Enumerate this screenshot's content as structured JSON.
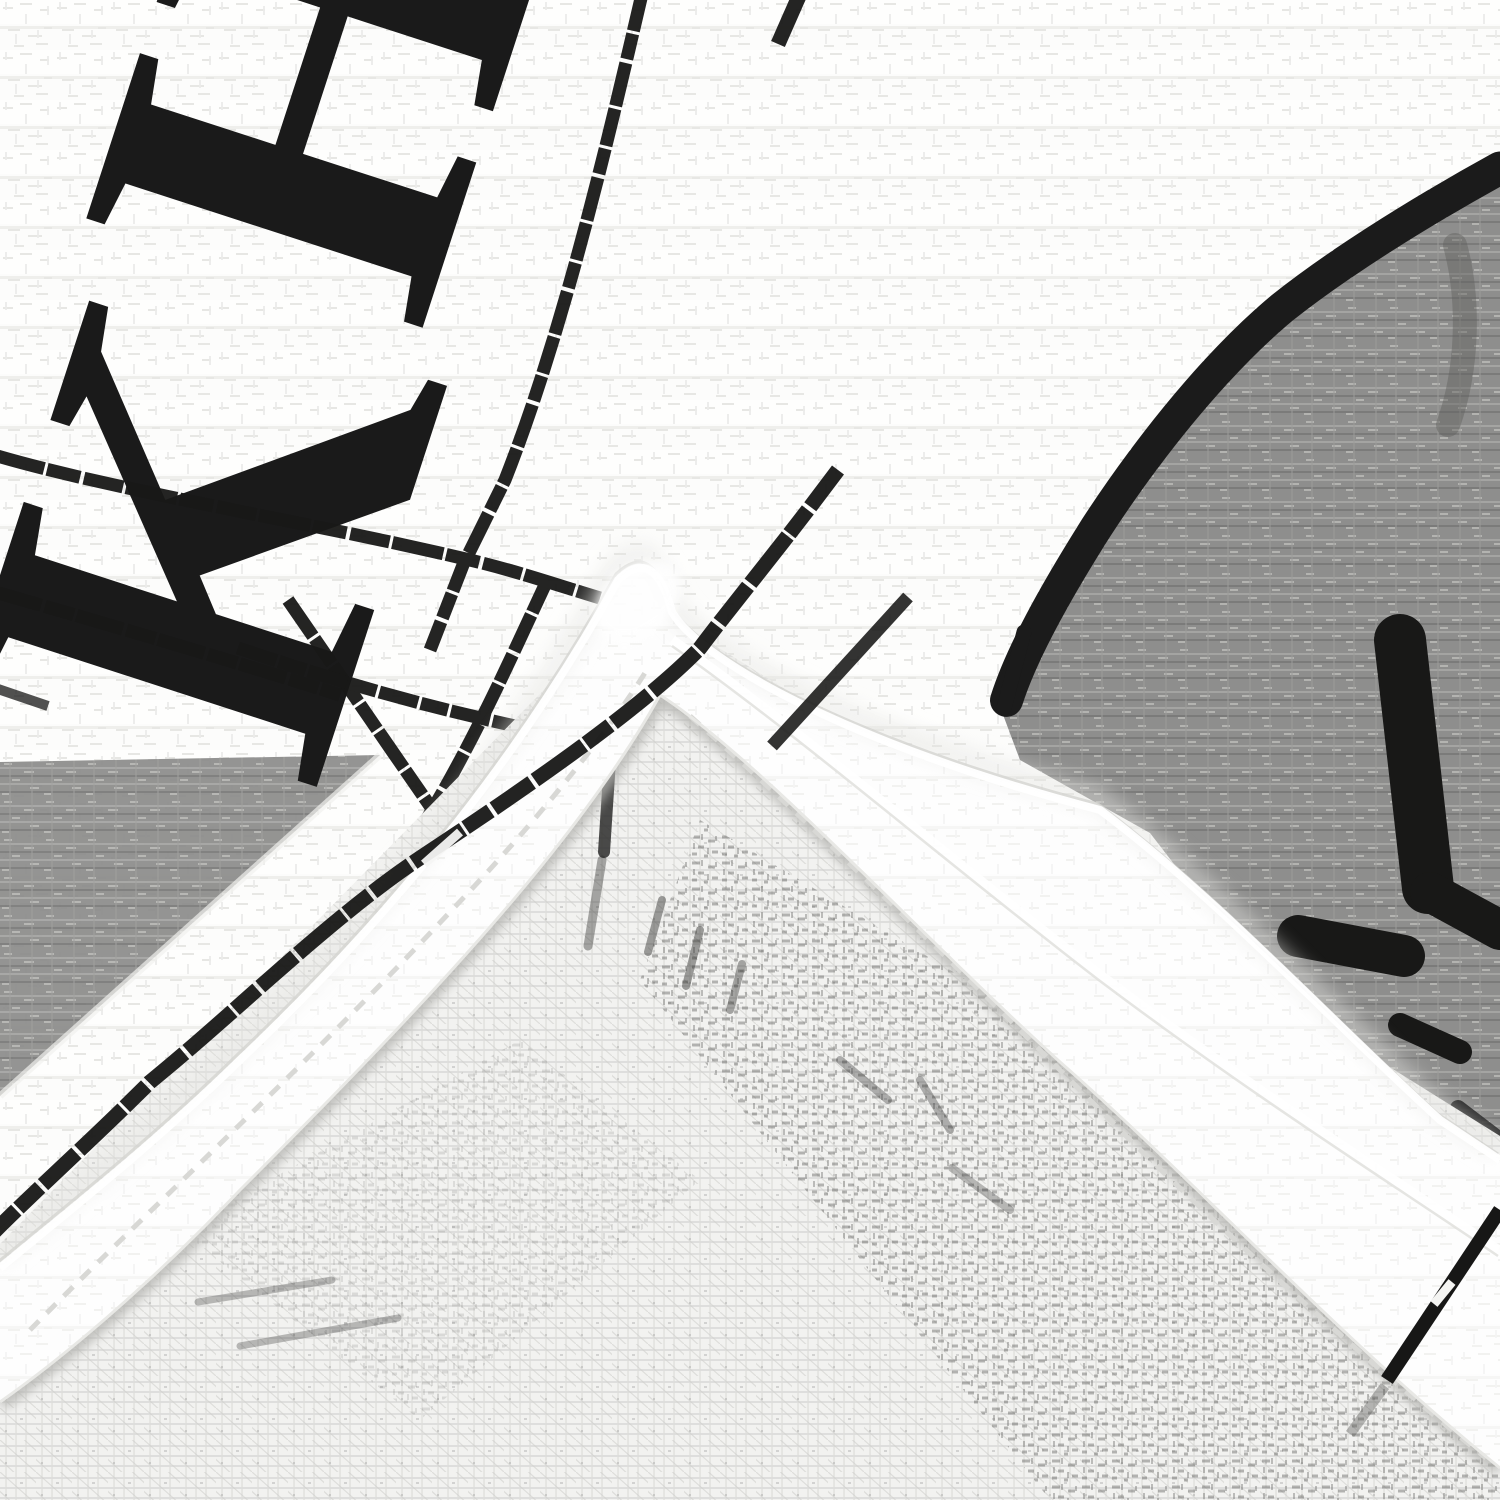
{
  "image": {
    "kind": "photograph-closeup",
    "subject": "Folded white waffle-weave kitchen tea towel with black printed lettering, printed grid lines and a gray printed graphic; hemmed corner folded diagonally over the sheer woven underside",
    "print": {
      "letter_top": "H",
      "letter_bottom": "K",
      "letters_note": "large black serif letters of the towel print, rotated and partially cropped",
      "ink_color": "#1a1a1a"
    },
    "regions": {
      "front_fabric": "white waffle-weave cotton",
      "grid_lines": "thin black printed window-pane lines crossing diagonally",
      "border_line": "black printed border line running parallel to the hem",
      "gray_graphic_top_right": "gray printed panel outlined with a thick black brush stroke and black marks",
      "gray_graphic_left": "gray printed triangle at the left edge",
      "hem_band": "bright white folded hem running diagonally through the corner with stitch lines",
      "underside": "sheer open-weave back of the towel with dark print showing through"
    },
    "colors": {
      "front_base": "#fbfbfa",
      "weave_shadow": "#e7e7e4",
      "hem_white": "#ffffff",
      "stitch": "#d8d8d5",
      "sheer_base": "#f2f2f0",
      "sheer_lines": "#d9d9d6",
      "gray_print": "#8e8e8d",
      "gray_print_light": "#a6a6a4",
      "ink": "#1a1a1a"
    }
  }
}
